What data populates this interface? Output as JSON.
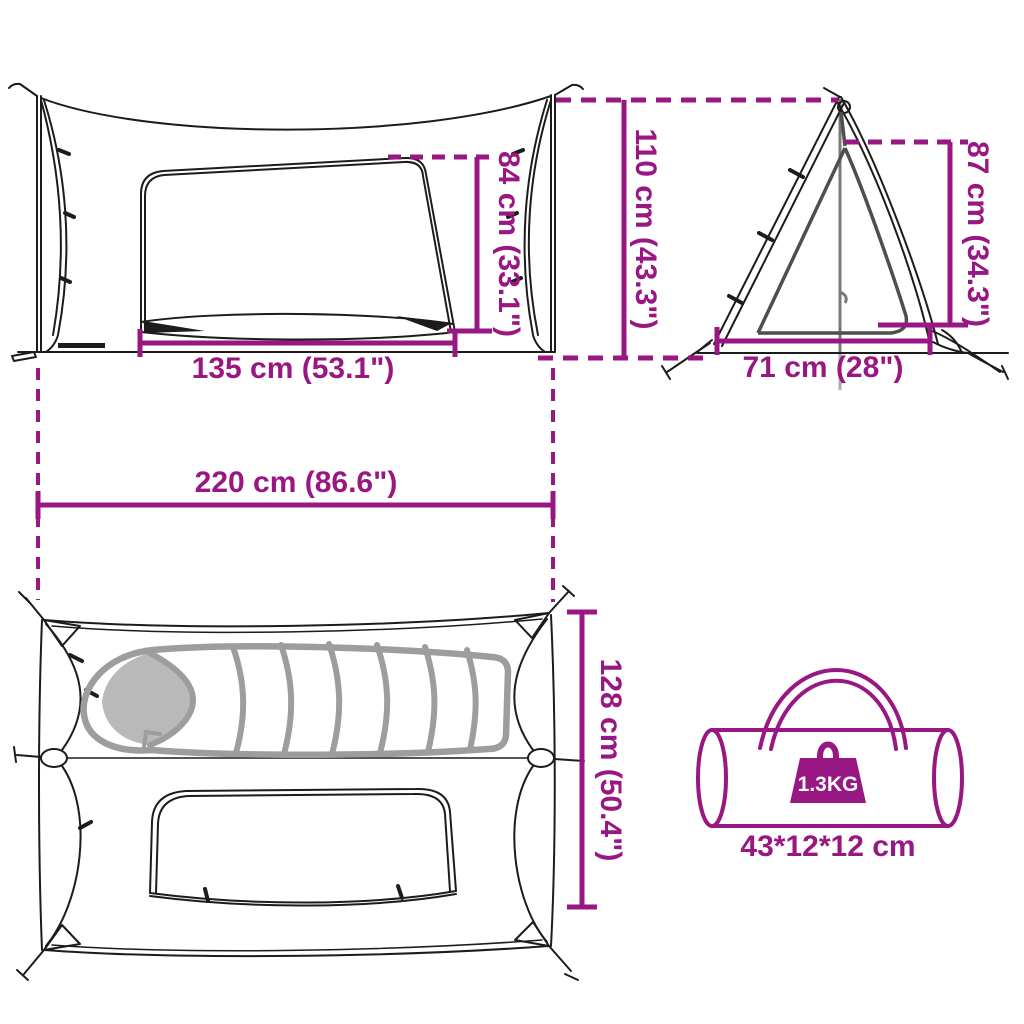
{
  "diagram": {
    "colors": {
      "accent": "#981782",
      "line_art": "#1c1c1c",
      "sleeping_bag_gray": "#9d9d9d"
    },
    "views": {
      "front": {
        "door_width_label": "135 cm (53.1\")",
        "door_height_label": "84 cm (33.1\")"
      },
      "side": {
        "total_height_label": "110 cm (43.3\")",
        "inner_height_label": "87 cm (34.3\")",
        "base_depth_label": "71 cm (28\")"
      },
      "top": {
        "total_length_label": "220 cm (86.6\")",
        "total_width_label": "128 cm (50.4\")"
      },
      "carry_bag": {
        "weight_label": "1.3KG",
        "size_label": "43*12*12 cm"
      }
    }
  }
}
